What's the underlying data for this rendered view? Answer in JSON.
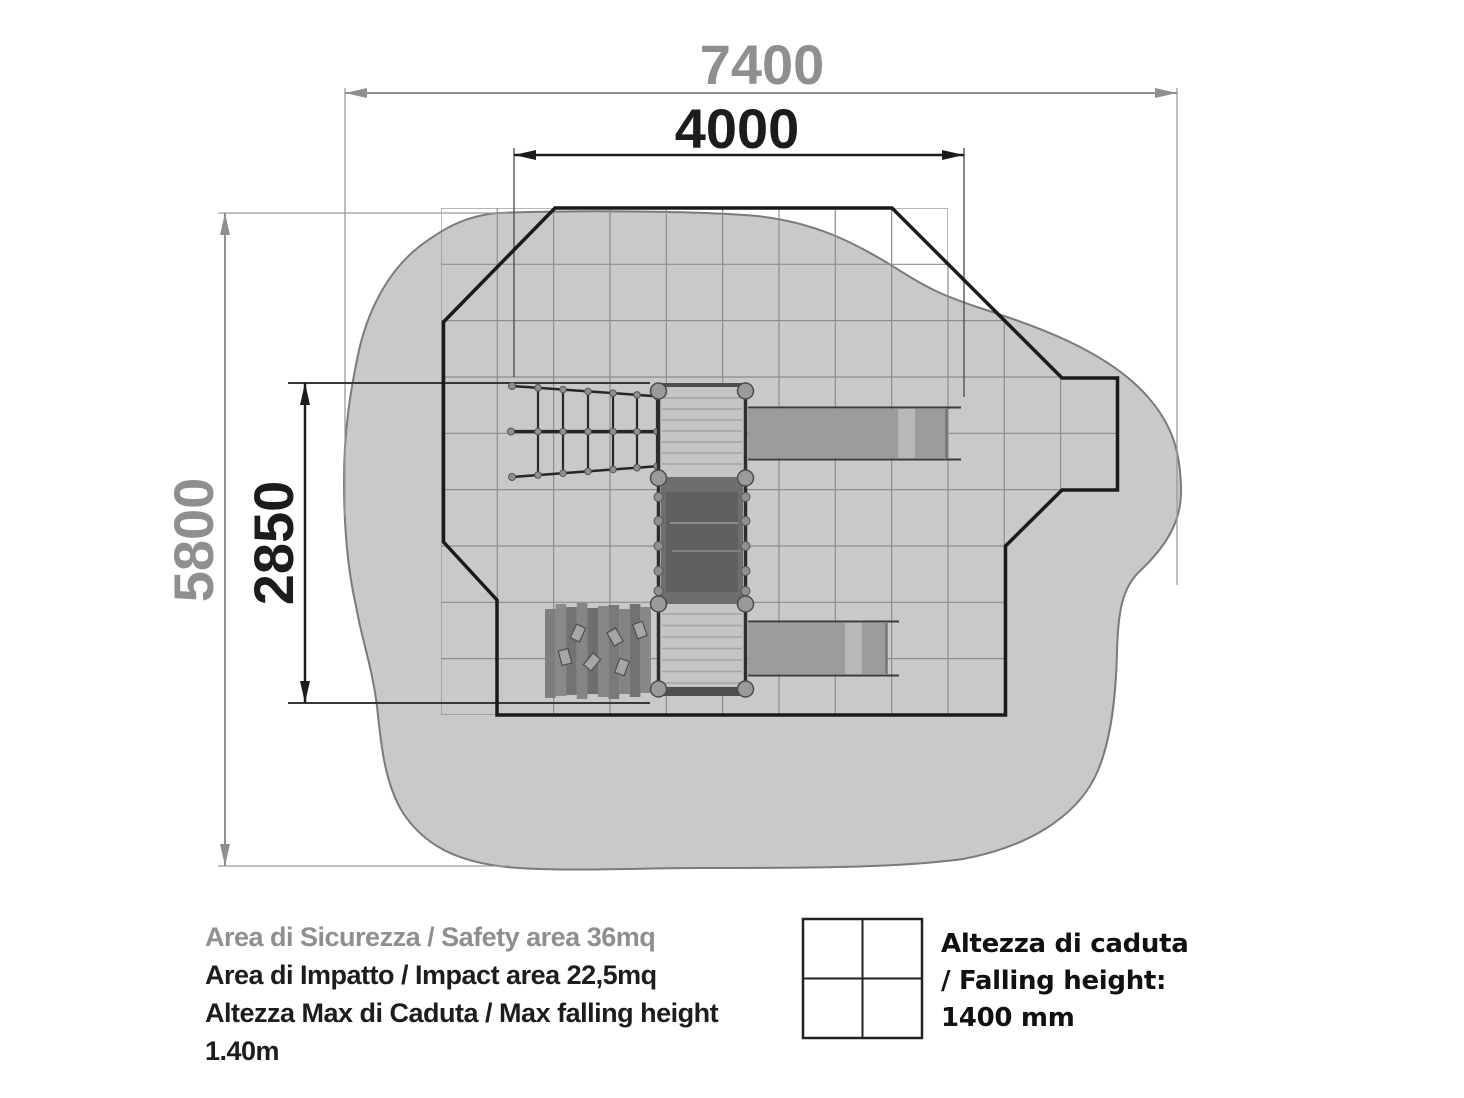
{
  "diagram": {
    "type": "playground-safety-area-plan"
  },
  "dimensions": {
    "total_width_mm": "7400",
    "inner_width_mm": "4000",
    "total_depth_mm": "5800",
    "inner_depth_mm": "2850"
  },
  "notes": {
    "safety_area": "Area di Sicurezza / Safety area 36mq",
    "impact_area": "Area di Impatto / Impact area 22,5mq",
    "max_falling_height_line1": "Altezza Max di Caduta / Max falling height",
    "max_falling_height_line2": "1.40m"
  },
  "falling_height_legend": {
    "symbol": "quartered-square-icon",
    "line1": "Altezza di caduta",
    "line2": "/ Falling height:",
    "line3": "1400 mm"
  },
  "colors": {
    "safety_area_fill": "#c9c9c9",
    "safety_area_stroke": "#7a7a7a",
    "grid_line": "#8d8d8d",
    "impact_outline": "#1a1a1a",
    "dim_gray": "#8f8f8f",
    "dim_black": "#1c1c1c",
    "deck_light": "#c5c5c5",
    "bridge_dark": "#6e6e6e",
    "slide_gray": "#9c9c9c",
    "slide_highlight": "#b9b9b9",
    "post_gray": "#9a9a9a",
    "wall_plank_base": "#7b7b7b"
  }
}
